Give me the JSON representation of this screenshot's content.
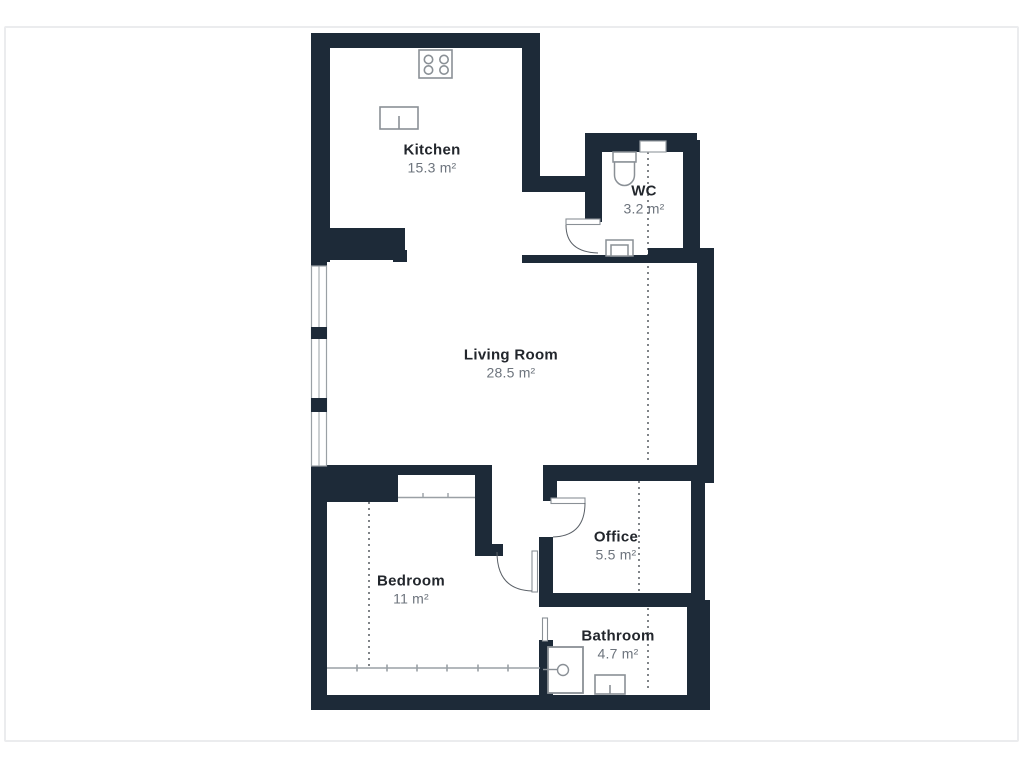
{
  "floorplan": {
    "title": "Apartment floor plan",
    "rooms": [
      {
        "id": "kitchen",
        "name": "Kitchen",
        "area": "15.3 m²"
      },
      {
        "id": "wc",
        "name": "WC",
        "area": "3.2 m²"
      },
      {
        "id": "living-room",
        "name": "Living Room",
        "area": "28.5 m²"
      },
      {
        "id": "bedroom",
        "name": "Bedroom",
        "area": "11 m²"
      },
      {
        "id": "office",
        "name": "Office",
        "area": "5.5 m²"
      },
      {
        "id": "bathroom",
        "name": "Bathroom",
        "area": "4.7 m²"
      }
    ],
    "fixtures": [
      "stove-icon",
      "kitchen-sink-icon",
      "toilet-icon",
      "wc-sink-icon",
      "shower-icon",
      "bathroom-sink-icon",
      "wardrobe-line",
      "closet-line"
    ],
    "colors": {
      "wall": "#1d2a38",
      "room_name_text": "#22262c",
      "area_text": "#6d747d",
      "fixture_stroke": "#8a9096",
      "dotted_line": "#4a4f55",
      "frame_border": "#ebecee",
      "background": "#ffffff"
    }
  }
}
